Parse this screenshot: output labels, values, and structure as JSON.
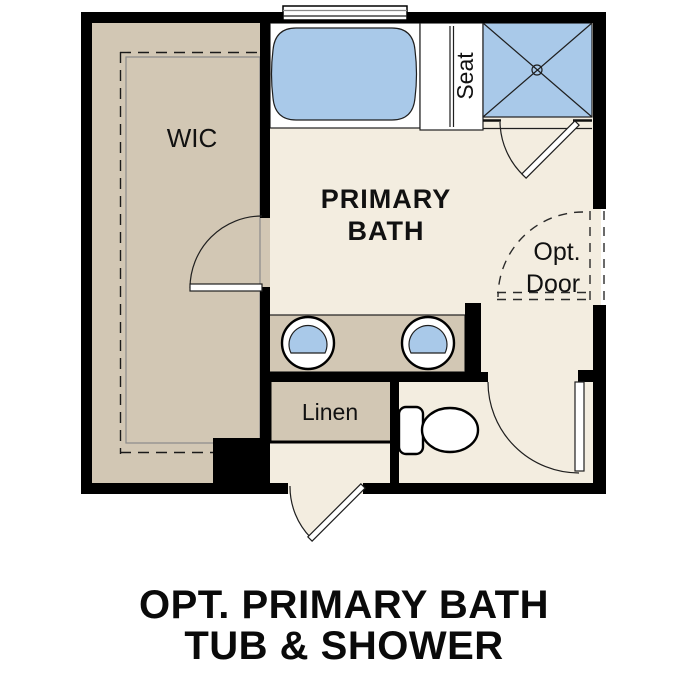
{
  "plan": {
    "rooms": {
      "wic": "WIC",
      "primary_bath_line1": "PRIMARY",
      "primary_bath_line2": "BATH"
    },
    "labels": {
      "seat": "Seat",
      "linen": "Linen",
      "opt_door_line1": "Opt.",
      "opt_door_line2": "Door"
    },
    "caption": {
      "line1": "OPT. PRIMARY BATH",
      "line2": "TUB & SHOWER"
    },
    "colors": {
      "wall_black": "#000000",
      "floor_cream": "#f3ede0",
      "closet_tan": "#d2c7b4",
      "fixture_blue": "#a9c9e9",
      "fixture_white": "#ffffff"
    }
  }
}
